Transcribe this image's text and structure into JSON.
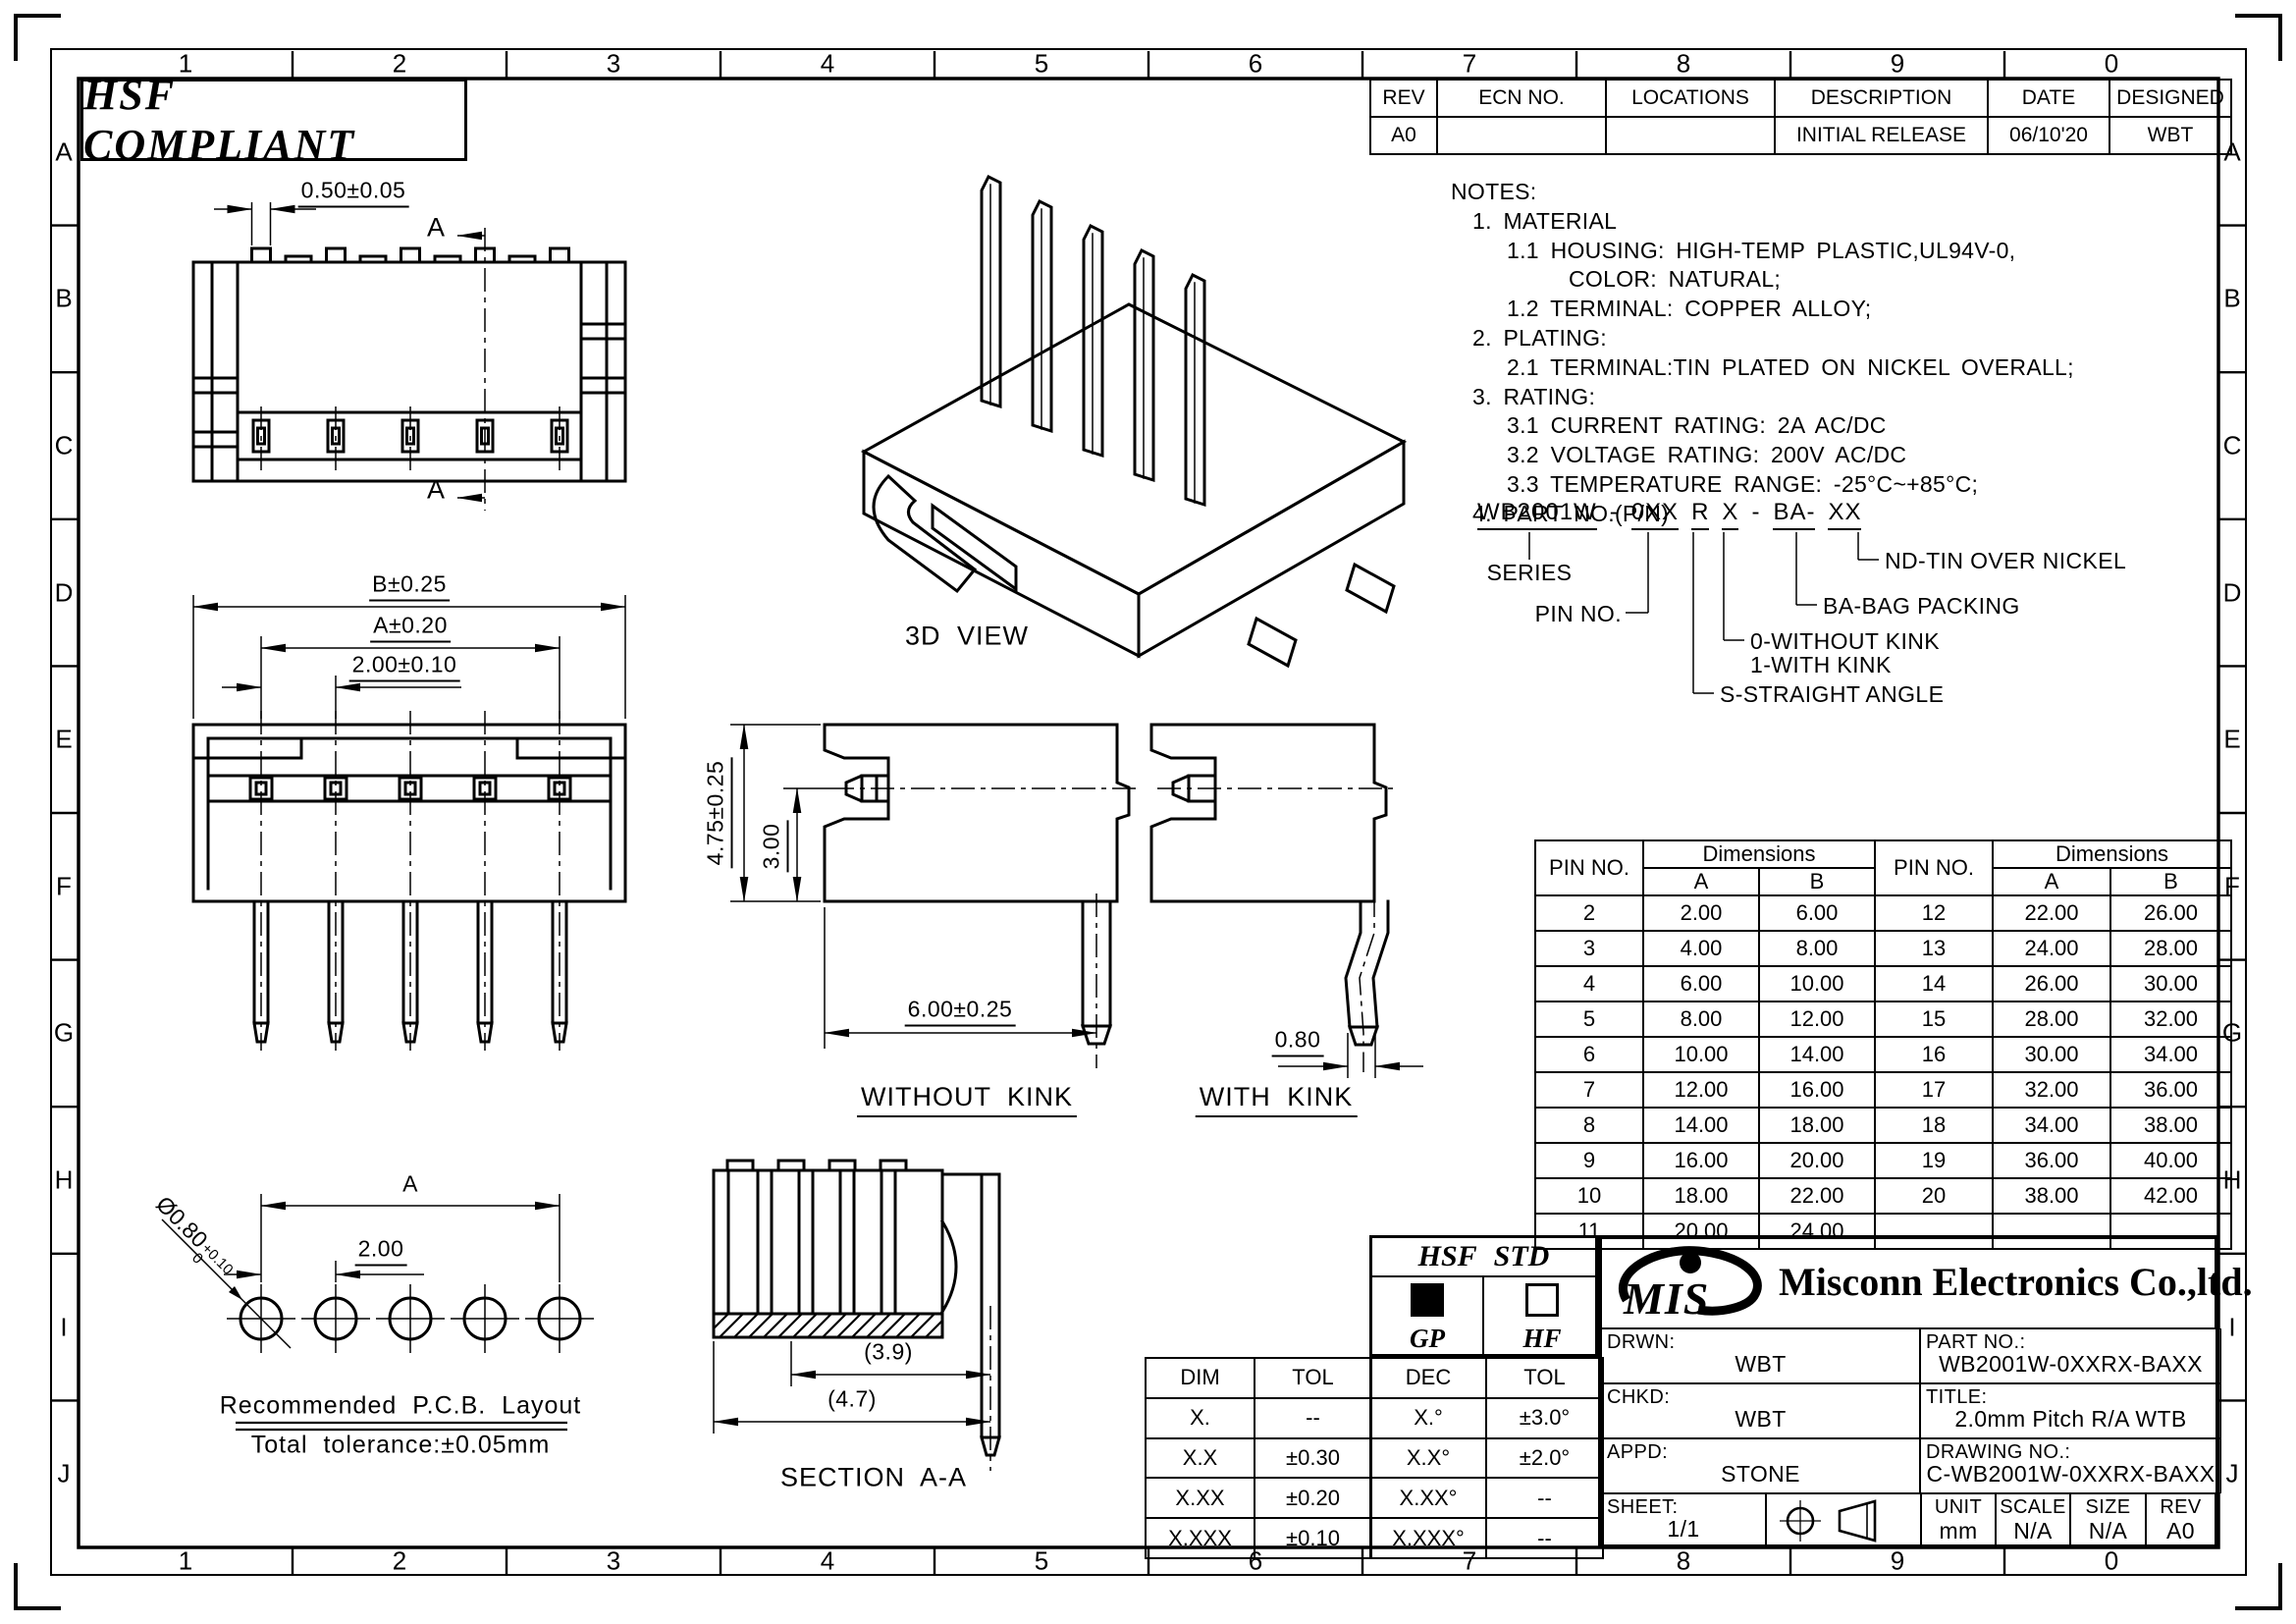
{
  "sheet": {
    "compliance": "HSF COMPLIANT"
  },
  "border": {
    "columns": [
      "1",
      "2",
      "3",
      "4",
      "5",
      "6",
      "7",
      "8",
      "9",
      "0"
    ],
    "rows": [
      "A",
      "B",
      "C",
      "D",
      "E",
      "F",
      "G",
      "H",
      "I",
      "J"
    ]
  },
  "revision_table": {
    "headers": [
      "REV",
      "ECN NO.",
      "LOCATIONS",
      "DESCRIPTION",
      "DATE",
      "DESIGNED"
    ],
    "row": [
      "A0",
      "",
      "",
      "INITIAL RELEASE",
      "06/10'20",
      "WBT"
    ]
  },
  "notes": {
    "lines": [
      {
        "text": "NOTES:",
        "indent": 0
      },
      {
        "text": "1.  MATERIAL",
        "indent": 1
      },
      {
        "text": "1.1  HOUSING:  HIGH-TEMP  PLASTIC,UL94V-0,",
        "indent": 2
      },
      {
        "text": "COLOR:  NATURAL;",
        "indent": 3
      },
      {
        "text": "1.2  TERMINAL:  COPPER  ALLOY;",
        "indent": 2
      },
      {
        "text": "2.  PLATING:",
        "indent": 1
      },
      {
        "text": "2.1  TERMINAL:TIN  PLATED  ON  NICKEL  OVERALL;",
        "indent": 2
      },
      {
        "text": "3.  RATING:",
        "indent": 1
      },
      {
        "text": "3.1  CURRENT  RATING:  2A  AC/DC",
        "indent": 2
      },
      {
        "text": "3.2  VOLTAGE  RATING:  200V  AC/DC",
        "indent": 2
      },
      {
        "text": "3.3  TEMPERATURE  RANGE:  -25°C~+85°C;",
        "indent": 2
      },
      {
        "text": "4.  PART  NO.(P/N)",
        "indent": 1
      }
    ]
  },
  "part_number": {
    "segments": [
      {
        "text": "WB2001W",
        "u": true
      },
      {
        "text": "-",
        "u": false
      },
      {
        "text": "0XX",
        "u": true
      },
      {
        "text": "R",
        "u": true
      },
      {
        "text": "X",
        "u": true
      },
      {
        "text": "-",
        "u": false
      },
      {
        "text": "BA-",
        "u": true
      },
      {
        "text": "XX",
        "u": true
      }
    ],
    "callouts": {
      "series": "SERIES",
      "pin_no": "PIN NO.",
      "without_kink": "0-WITHOUT KINK",
      "with_kink": "1-WITH KINK",
      "straight": "S-STRAIGHT ANGLE",
      "bag": "BA-BAG PACKING",
      "nd": "ND-TIN OVER NICKEL"
    }
  },
  "pin_table": {
    "pin_no_header": "PIN NO.",
    "dim_header": "Dimensions",
    "col_a": "A",
    "col_b": "B",
    "rows": [
      [
        "2",
        "2.00",
        "6.00",
        "12",
        "22.00",
        "26.00"
      ],
      [
        "3",
        "4.00",
        "8.00",
        "13",
        "24.00",
        "28.00"
      ],
      [
        "4",
        "6.00",
        "10.00",
        "14",
        "26.00",
        "30.00"
      ],
      [
        "5",
        "8.00",
        "12.00",
        "15",
        "28.00",
        "32.00"
      ],
      [
        "6",
        "10.00",
        "14.00",
        "16",
        "30.00",
        "34.00"
      ],
      [
        "7",
        "12.00",
        "16.00",
        "17",
        "32.00",
        "36.00"
      ],
      [
        "8",
        "14.00",
        "18.00",
        "18",
        "34.00",
        "38.00"
      ],
      [
        "9",
        "16.00",
        "20.00",
        "19",
        "36.00",
        "40.00"
      ],
      [
        "10",
        "18.00",
        "22.00",
        "20",
        "38.00",
        "42.00"
      ],
      [
        "11",
        "20.00",
        "24.00",
        "",
        "",
        ""
      ]
    ]
  },
  "views": {
    "top": {
      "dim": "0.50±0.05",
      "section_letter": "A"
    },
    "front": {
      "dim_b": "B±0.25",
      "dim_a": "A±0.20",
      "dim_pitch": "2.00±0.10"
    },
    "three_d": {
      "label": "3D VIEW"
    },
    "without_kink": {
      "label": "WITHOUT KINK",
      "dim_height": "4.75±0.25",
      "dim_inner": "3.00",
      "dim_width": "6.00±0.25"
    },
    "with_kink": {
      "label": "WITH KINK",
      "dim": "0.80"
    },
    "section": {
      "label": "SECTION A-A",
      "dim_inner": "(3.9)",
      "dim_outer": "(4.7)"
    },
    "pcb": {
      "title": "Recommended P.C.B. Layout",
      "tolerance": "Total tolerance:±0.05mm",
      "hole": "Ø0.80",
      "hole_plus": "+0.10",
      "hole_minus": "0",
      "dim_pitch": "2.00",
      "dim_a": "A"
    }
  },
  "hsf_block": {
    "title": "HSF STD",
    "gp": "GP",
    "hf": "HF"
  },
  "dim_tol_table": {
    "headers": [
      "DIM",
      "TOL"
    ],
    "rows": [
      [
        "X.",
        "--"
      ],
      [
        "X.X",
        "±0.30"
      ],
      [
        "X.XX",
        "±0.20"
      ],
      [
        "X.XXX",
        "±0.10"
      ]
    ]
  },
  "dec_tol_table": {
    "headers": [
      "DEC",
      "TOL"
    ],
    "rows": [
      [
        "X.°",
        "±3.0°"
      ],
      [
        "X.X°",
        "±2.0°"
      ],
      [
        "X.XX°",
        "--"
      ],
      [
        "X.XXX°",
        "--"
      ]
    ]
  },
  "title_block": {
    "logo": "MIS",
    "company": "Misconn Electronics Co.,ltd.",
    "drwn_label": "DRWN:",
    "drwn": "WBT",
    "chkd_label": "CHKD:",
    "chkd": "WBT",
    "appd_label": "APPD:",
    "appd": "STONE",
    "part_no_label": "PART NO.:",
    "part_no": "WB2001W-0XXRX-BAXX",
    "title_label": "TITLE:",
    "title": "2.0mm Pitch R/A WTB",
    "drawing_no_label": "DRAWING NO.:",
    "drawing_no": "C-WB2001W-0XXRX-BAXX",
    "sheet_label": "SHEET:",
    "sheet": "1/1",
    "unit_label": "UNIT",
    "unit": "mm",
    "scale_label": "SCALE",
    "scale": "N/A",
    "size_label": "SIZE",
    "size": "N/A",
    "rev_label": "REV",
    "rev": "A0"
  }
}
